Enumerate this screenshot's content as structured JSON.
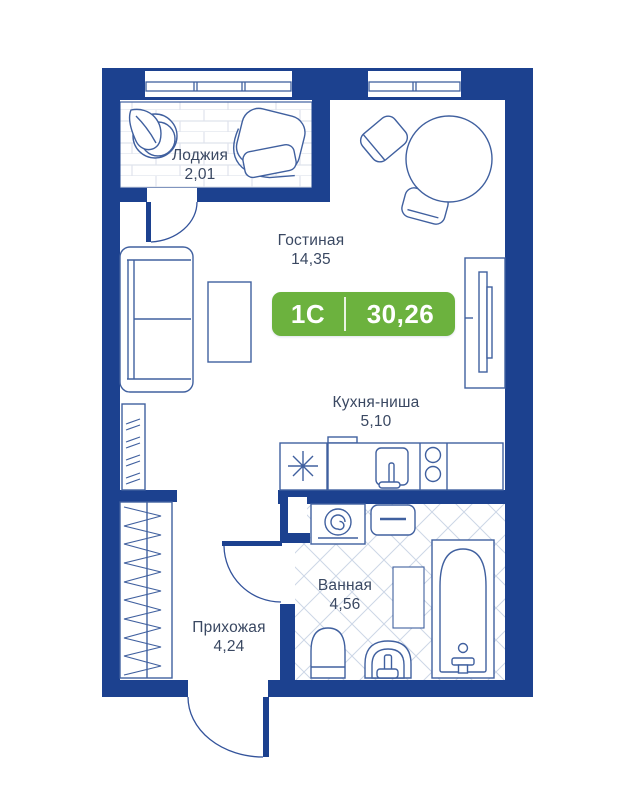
{
  "plan": {
    "badge": {
      "type": "1C",
      "area": "30,26"
    },
    "rooms": [
      {
        "name": "Лоджия",
        "area": "2,01"
      },
      {
        "name": "Гостиная",
        "area": "14,35"
      },
      {
        "name": "Кухня-ниша",
        "area": "5,10"
      },
      {
        "name": "Ванная",
        "area": "4,56"
      },
      {
        "name": "Прихожая",
        "area": "4,24"
      }
    ],
    "colors": {
      "wall": "#1c418f",
      "furniture_stroke": "#40609f",
      "door_stroke": "#33539b",
      "label_text": "#3a4862",
      "badge_green": "#6cb23e",
      "tile_line": "#ccd6e6",
      "brick_line": "#dfe3ec"
    },
    "furniture": [
      "plant",
      "armchair",
      "dining-table",
      "dining-chair",
      "sofa",
      "coffee-table",
      "tv-stand",
      "dresser",
      "wardrobe",
      "fridge",
      "kitchen-sink",
      "stove",
      "washing-machine",
      "shelf",
      "bathtub",
      "bath-rug",
      "toilet",
      "bath-sink"
    ]
  }
}
